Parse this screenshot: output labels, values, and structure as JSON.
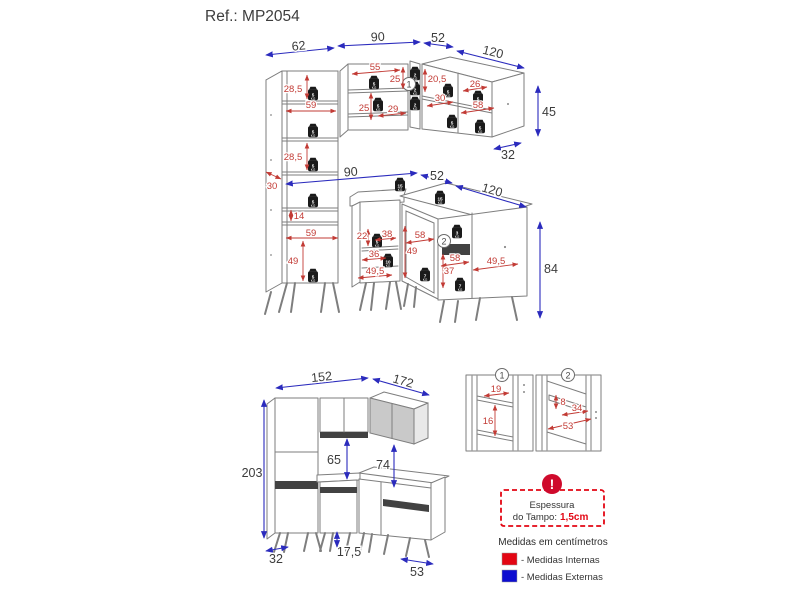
{
  "title": "Ref.: MP2054",
  "markers": {
    "m1": "1",
    "m2": "2"
  },
  "weights": {
    "w2": "2",
    "w3": "3",
    "w5": "5",
    "w7": "7",
    "w10": "10",
    "w15": "15",
    "unit": "KG"
  },
  "dims": {
    "external": {
      "wall_left_w": "62",
      "wall_mid_w": "90",
      "wall_corner_w": "52",
      "wall_right_w": "120",
      "wall_right_h": "45",
      "wall_right_d": "32",
      "base_mid_w": "90",
      "base_corner_w": "52",
      "base_right_w": "120",
      "base_h": "84",
      "asm_left_w": "152",
      "asm_right_w": "172",
      "asm_h": "203",
      "asm_gap_upper": "65",
      "asm_gap_corner": "74",
      "asm_depth": "32",
      "asm_leg_h": "17,5",
      "asm_base_d": "53"
    },
    "internal": {
      "tall_top_h": "28,5",
      "tall_shelf_w": "59",
      "tall_mid_h": "28,5",
      "tall_depth": "30",
      "tall_gap_h": "14",
      "tall_shelf_w2": "59",
      "tall_bottom_h": "49",
      "wall_shelf_w": "55",
      "wall_top_h": "25",
      "wall_mid_h": "25",
      "wall_bottom_w": "29",
      "corner_h": "20,5",
      "right_shelf_w": "30",
      "right_top_w": "26",
      "right_bottom_w": "58",
      "base_top_h": "22",
      "base_shelf_w": "38",
      "base_mid_w": "36",
      "base_bottom_w": "49,5",
      "cdoor_w": "58",
      "cdoor_h": "49",
      "cinner_w": "58",
      "cinner_h": "37",
      "cright_w": "49,5",
      "d1_w": "19",
      "d1_h": "16",
      "d2_h": "8",
      "d2_w": "34",
      "d2_bottom_w": "53"
    }
  },
  "legend": {
    "warning": "!",
    "notice_l1": "Espessura",
    "notice_l2": "do Tampo:",
    "notice_value": "1,5cm",
    "units": "Medidas em centímetros",
    "internal": "- Medidas Internas",
    "external": "- Medidas Externas"
  }
}
